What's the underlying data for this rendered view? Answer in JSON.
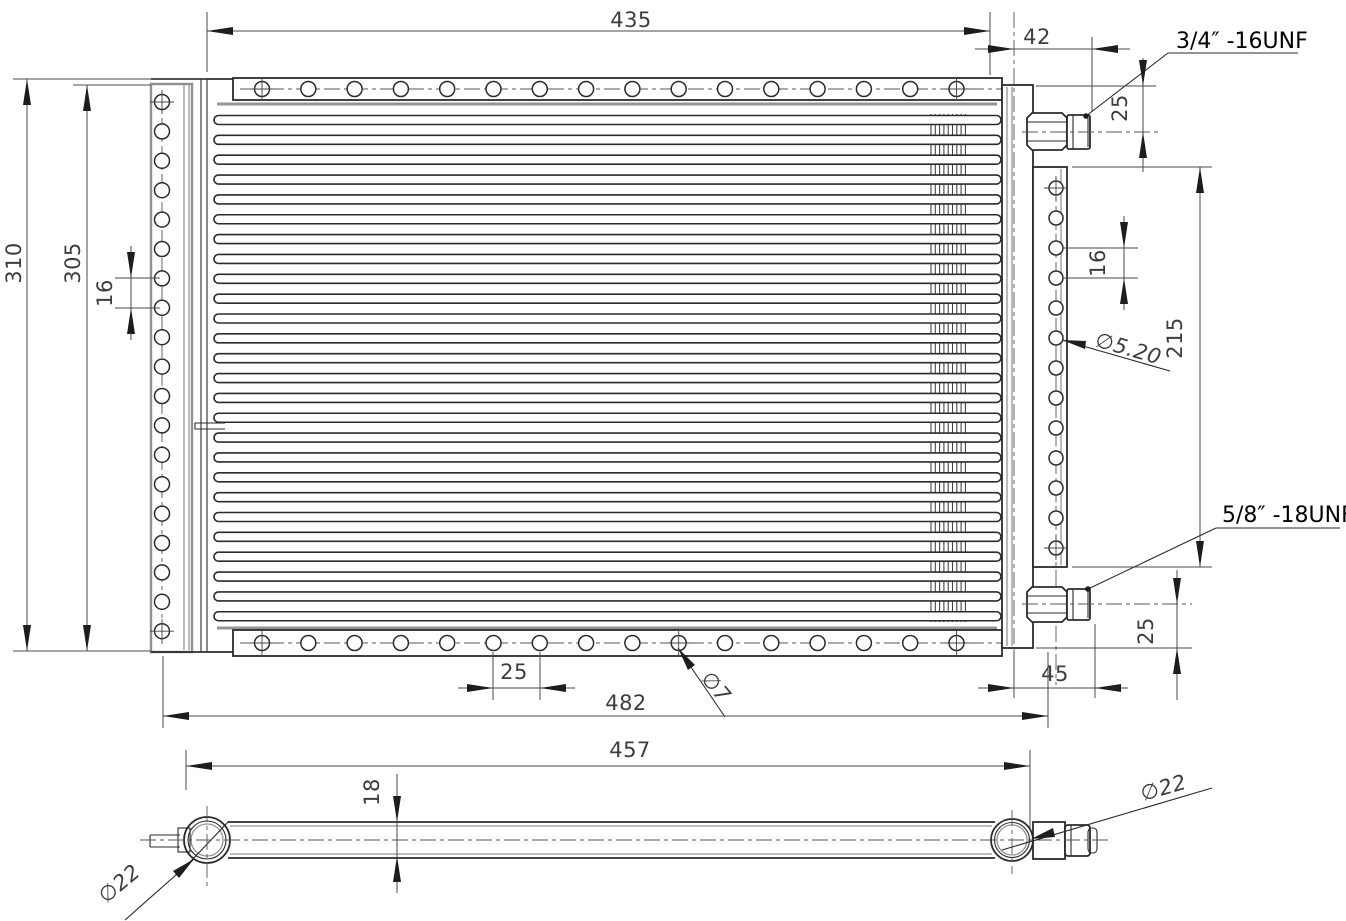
{
  "drawing": {
    "front_view": {
      "dim_width_top": "435",
      "dim_fitting_offset_top": "42",
      "label_fitting_top_thread": "3/4″ -16UNF",
      "dim_fitting_top_drop": "25",
      "dim_overall_height": "310",
      "dim_core_height": "305",
      "dim_left_hole_pitch": "16",
      "dim_right_hole_pitch": "16",
      "dim_right_bracket_height": "215",
      "label_right_hole_dia": "∅5.20",
      "label_fitting_bottom_thread": "5/8″ -18UNF",
      "dim_fitting_bottom_drop": "25",
      "dim_fitting_offset_bottom": "45",
      "dim_mounting_width": "482",
      "dim_bottom_hole_pitch": "25",
      "label_bottom_hole_dia": "∅7"
    },
    "side_view": {
      "dim_tube_length": "457",
      "dim_core_thickness": "18",
      "label_left_header_dia": "∅22",
      "label_right_header_dia": "∅22"
    },
    "colors": {
      "object_line": "#2b2b2b",
      "auxiliary_line": "#8f8f8f",
      "dimension_line": "#4a4a4a",
      "dimension_text": "#3d3d3d",
      "label_text": "#000000",
      "background": "#ffffff"
    }
  }
}
